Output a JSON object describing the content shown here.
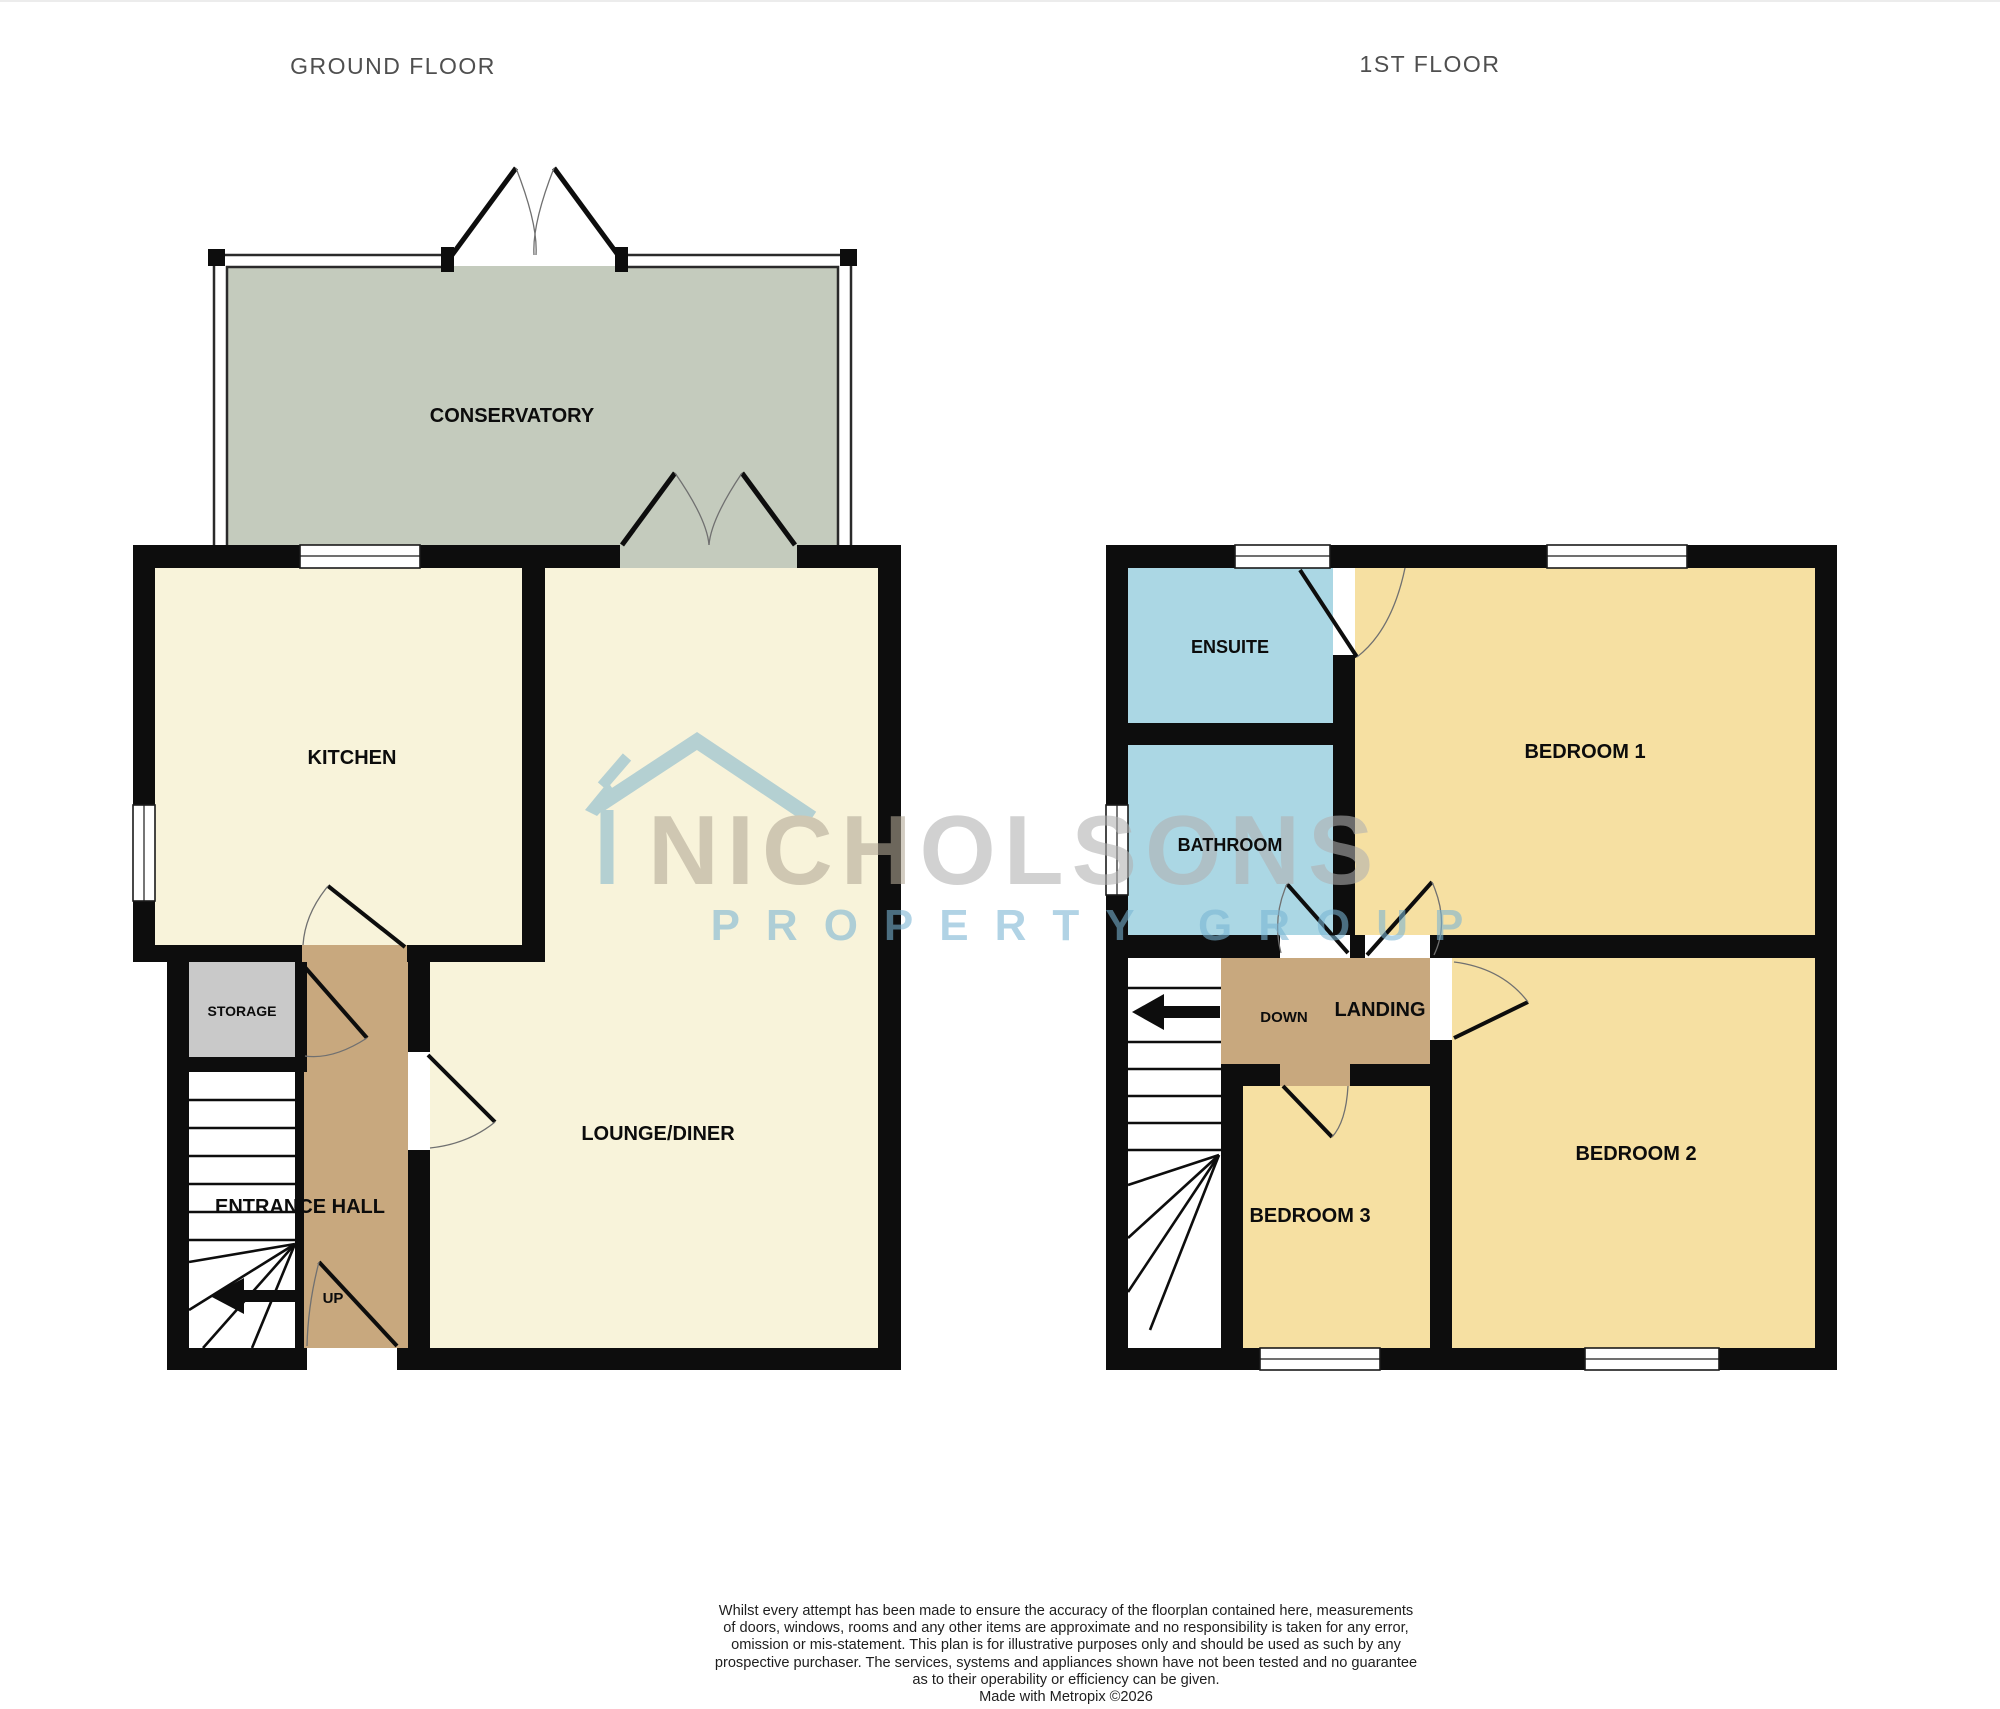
{
  "titles": {
    "ground_floor": "GROUND FLOOR",
    "first_floor": "1ST FLOOR"
  },
  "ground_floor": {
    "rooms": {
      "conservatory": {
        "label": "CONSERVATORY"
      },
      "kitchen": {
        "label": "KITCHEN"
      },
      "lounge_diner": {
        "label": "LOUNGE/DINER"
      },
      "storage": {
        "label": "STORAGE"
      },
      "entrance_hall": {
        "label": "ENTRANCE HALL"
      }
    },
    "stairs_direction_label": "UP"
  },
  "first_floor": {
    "rooms": {
      "ensuite": {
        "label": "ENSUITE"
      },
      "bathroom": {
        "label": "BATHROOM"
      },
      "bedroom_1": {
        "label": "BEDROOM 1"
      },
      "bedroom_2": {
        "label": "BEDROOM 2"
      },
      "bedroom_3": {
        "label": "BEDROOM 3"
      },
      "landing": {
        "label": "LANDING"
      }
    },
    "stairs_direction_label": "DOWN"
  },
  "watermark": {
    "brand": "NICHOLSONS",
    "brand_prefix": "NICH",
    "brand_suffix": "OLSONS",
    "tagline": "PROPERTY GROUP"
  },
  "disclaimer": {
    "lines": [
      "Whilst every attempt has been made to ensure the accuracy of the floorplan contained here, measurements",
      "of doors, windows, rooms and any other items are approximate and no responsibility is taken for any error,",
      "omission or mis-statement. This plan is for illustrative purposes only and should be used as such by any",
      "prospective purchaser. The services, systems and appliances shown have not been tested and no guarantee",
      "as to their operability or efficiency can be given.",
      "Made with Metropix ©2026"
    ]
  },
  "colors": {
    "room_cream": "#f8f3da",
    "conservatory_green": "#c4cbbd",
    "bedroom_yellow": "#f6e0a2",
    "bath_blue": "#abd7e4",
    "hall_tan": "#c8a87e",
    "storage_grey": "#c9c9c9",
    "wall_black": "#0d0d0d",
    "stair_white": "#ffffff",
    "watermark_blue": "#84b7cd",
    "tagline_blue": "#79b5d4",
    "brand_prefix_grey": "#b3a996",
    "brand_suffix_grey": "#b1b1b1",
    "title_grey": "#4f4f4f"
  }
}
